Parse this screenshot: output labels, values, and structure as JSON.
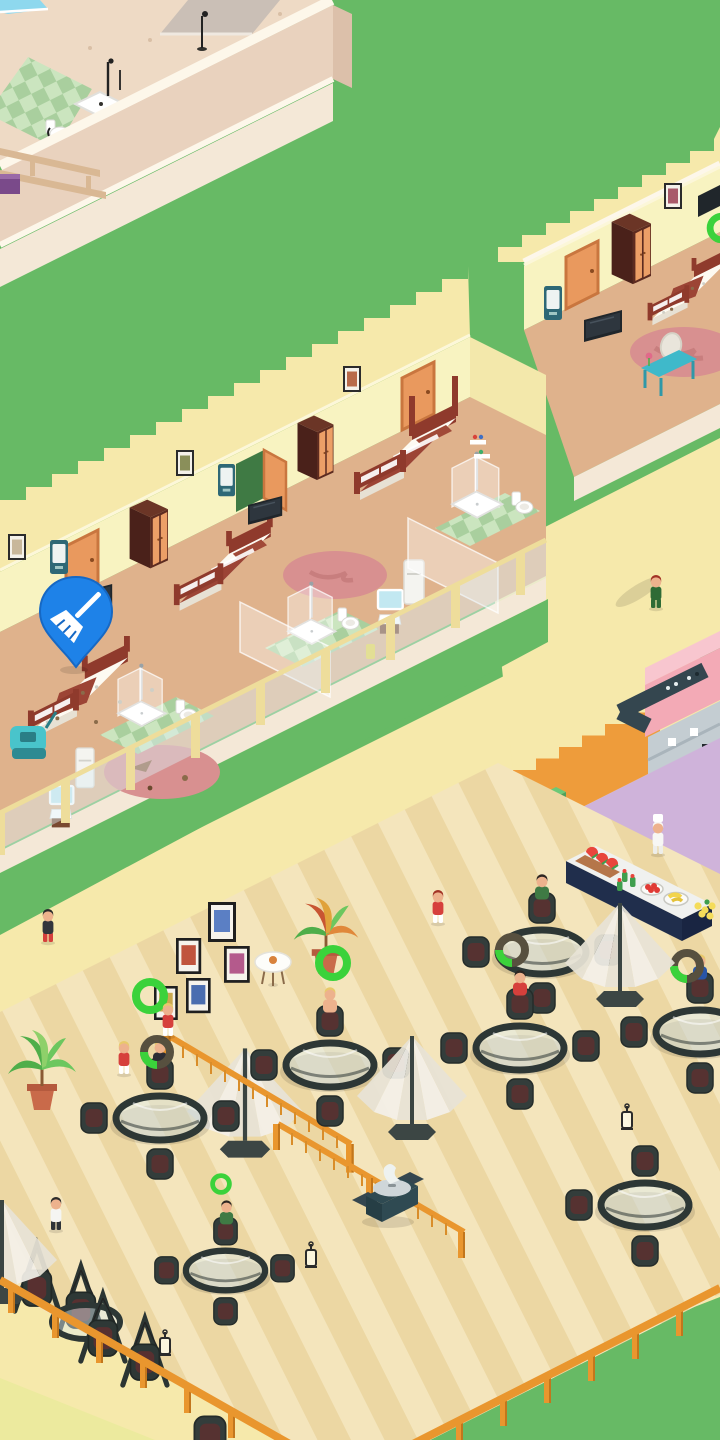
{
  "meta": {
    "description": "Isometric hotel-tycoon mobile game scene (dollhouse view), portrait 720x1440",
    "visible_text": "none - the screenshot contains no readable UI text"
  },
  "colors": {
    "grass": "#67ba65",
    "pathPale": "#f6e9ab",
    "pathCorner": "#ecea9e",
    "deckLight": "#f4e5bc",
    "deckDark": "#ecd7a3",
    "topFloor": "#eedac5",
    "edgeWhite": "#fdf7ea",
    "wallTan": "#e9d2be",
    "wallTanSide": "#dcc0aa",
    "wallTan2": "#f4e8d7",
    "tileA": "#a9cf9e",
    "tileB": "#cbe5bf",
    "roomWall": "#f8f3c1",
    "roomWallEnd": "#f3e8ab",
    "roomFloor": "#dfb28c",
    "doorOrange": "#e9995e",
    "doorFrame": "#c9763f",
    "wardDark": "#5d2b20",
    "wardSide": "#4a211a",
    "wardDoor": "#ec9f67",
    "bedFrame": "#8f3a2c",
    "blanket": "#9c4435",
    "mattress": "#fdfaf2",
    "mattressSide": "#e7e1d4",
    "pillow": "#a14a38",
    "rugPink": "#d89090",
    "rugDark": "#c87e7e",
    "tvBlack": "#20262b",
    "screenDark": "#2e363e",
    "tealBar": "#2e6876",
    "tealVanity": "#3fb9ca",
    "mirrorBlue": "#c2e8f1",
    "railYellow": "#eedd9b",
    "pinBlue": "#1e82e8",
    "pinEdge": "#1668c4",
    "fenceOrange": "#e9962e",
    "fenceDark": "#c2761c",
    "fenceLight": "#d98d2a",
    "tableDark": "#2d3735",
    "chairDark": "#333d3b",
    "cushion": "#5d3030",
    "umbWhite": "#f3f0e8",
    "umbShade": "#e7e3d6",
    "umbPole": "#3a4442",
    "kOrange": "#ee9c3b",
    "kPink": "#f3aab6",
    "kPinkLight": "#f8c6cf",
    "kPurple": "#cfb3da",
    "counterDark": "#34464f",
    "shelfGray": "#c4cdd2",
    "shelfLine": "#a9b4bb",
    "binGreen": "#5cba6a",
    "buffetTop": "#f0f1ef",
    "buffetNavy": "#202e4c",
    "buffetNavy2": "#192542",
    "boardBrown": "#b5764a",
    "melonRed": "#e8453c",
    "rind": "#3f9e4d",
    "banana": "#f2d44c",
    "lemon": "#f4dc5a",
    "tomato": "#e03a34",
    "ringGreen": "#3bd23b",
    "donutDark": "#57503f",
    "skin": "#edb28d",
    "hairBlond": "#e8c96a",
    "hairRed": "#a23325",
    "hairDark": "#2e2622",
    "maidRed": "#d6403c",
    "suitGreen": "#2f6b35",
    "suitBlue": "#2855a8",
    "vacTeal": "#49c4cb",
    "vacBase": "#2e8a92",
    "poolBlue": "#8ed8ee",
    "planterGray": "#cabfb6",
    "beamTan": "#d9b894",
    "purpleBox": "#7a4a8a",
    "openDoorGreen": "#3f7a44"
  },
  "indicators": {
    "cleaning_pin": {
      "shape": "map-pin",
      "glyph": "broom",
      "color": "#1e82e8",
      "meaning": "room needs cleaning"
    },
    "progress_ring_full": {
      "color": "#3bd23b",
      "meaning": "service complete"
    },
    "progress_donut": {
      "track": "#57503f",
      "arc": "#3bd23b",
      "meaning": "service in progress"
    }
  },
  "scene": {
    "upper_left_building": {
      "kind": "bathroom floor section",
      "items": [
        "green checker tile bathroom",
        "shower tray with pole",
        "toilet",
        "blue pool edge",
        "gray planter wall",
        "floor lamp",
        "wooden pergola beams",
        "purple bench"
      ]
    },
    "upper_right_room": {
      "kind": "hotel room (dirty bed)",
      "items": [
        "orange door",
        "mini fridge",
        "wardrobe",
        "wall picture",
        "wall tv",
        "double bed with litter",
        "floor tv",
        "pink rug",
        "teal vanity with mirror",
        "flower",
        "green progress ring (edge)"
      ]
    },
    "hotel_rooms_row": {
      "kind": "row of hotel rooms, dollhouse cutaway",
      "rooms": [
        {
          "state": "dirty",
          "items": [
            "picture",
            "closed door",
            "wardrobe",
            "minibar",
            "unmade bed with litter",
            "vacuum cart",
            "rug with litter",
            "tv",
            "shower",
            "toilet",
            "sink with mirror",
            "fridge",
            "green tiles"
          ]
        },
        {
          "state": "clean",
          "items": [
            "picture",
            "open door",
            "wardrobe",
            "minibar",
            "made bed",
            "tv",
            "rug",
            "shower",
            "toilet",
            "sink with mirror",
            "fridge",
            "yellow bin",
            "green tiles"
          ]
        },
        {
          "state": "clean",
          "items": [
            "picture",
            "closed door",
            "poster bed",
            "shower",
            "toilet",
            "toiletry shelf",
            "green tiles"
          ]
        }
      ],
      "front": "yellow framed glass balustrade",
      "flag": "blue broom pin over dirty bed"
    },
    "kitchen_block": {
      "items": [
        "orange wall with stepped top",
        "pink building corner",
        "dark kitchen counter",
        "gray shelving",
        "green recycle bin",
        "purple floor",
        "buffet counter with watermelon board, bottles, tomato bowl, banana plate, lemons",
        "chef"
      ]
    },
    "restaurant_terrace": {
      "floor": "striped wooden deck with orange fence",
      "tables_round_glass": 7,
      "swing_chair_set": 1,
      "umbrellas": 4,
      "stair_railings": 2,
      "decor": [
        "5 floating wall pictures",
        "white side table",
        "2 palm plants in pots",
        "bbq grill",
        "3 lanterns"
      ],
      "guests_seated": [
        "green shirt",
        "red-white outfit",
        "shirtless red shorts",
        "dark jacket blonde",
        "blue suit",
        "green shirt at small table"
      ],
      "staff_walking": [
        "dark-top waiter",
        "red-shirt runner",
        "2 red-white waitresses",
        "white-shirt waiter",
        "green suit manager",
        "chef"
      ]
    }
  }
}
